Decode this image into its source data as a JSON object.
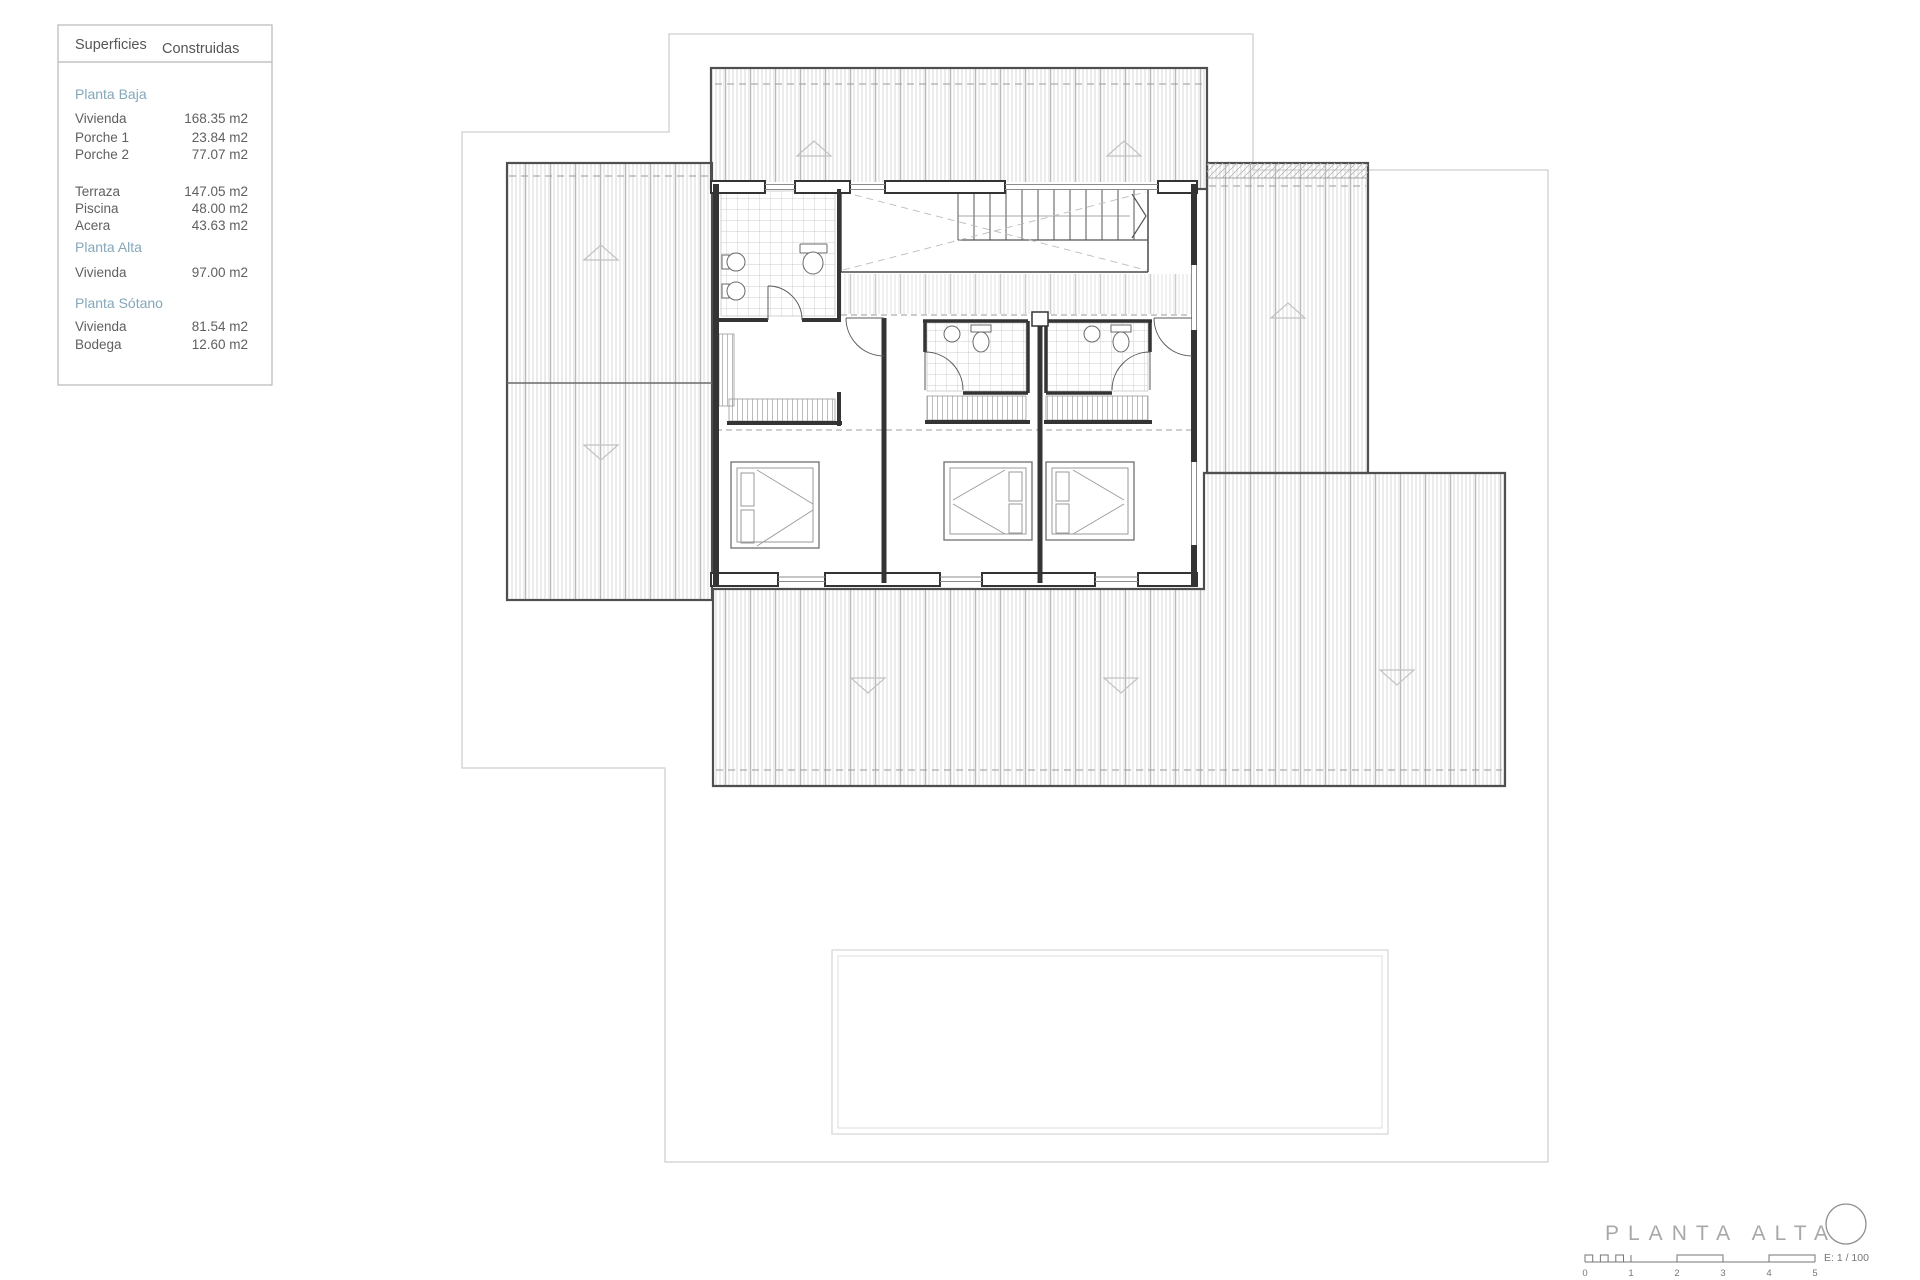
{
  "legend": {
    "header": {
      "col1": "Superficies",
      "col2": "Construidas"
    },
    "planta_baja": {
      "title": "Planta Baja",
      "rows": [
        {
          "label": "Vivienda",
          "value": "168.35 m2"
        },
        {
          "label": "Porche 1",
          "value": "23.84 m2"
        },
        {
          "label": "Porche 2",
          "value": "77.07 m2"
        },
        {
          "label": "Terraza",
          "value": "147.05 m2"
        },
        {
          "label": "Piscina",
          "value": "48.00 m2"
        },
        {
          "label": "Acera",
          "value": "43.63 m2"
        }
      ]
    },
    "planta_alta": {
      "title": "Planta Alta",
      "rows": [
        {
          "label": "Vivienda",
          "value": "97.00 m2"
        }
      ]
    },
    "planta_sotano": {
      "title": "Planta Sótano",
      "rows": [
        {
          "label": "Vivienda",
          "value": "81.54 m2"
        },
        {
          "label": "Bodega",
          "value": "12.60 m2"
        }
      ]
    }
  },
  "title_block": {
    "title": "PLANTA ALTA",
    "scale_label": "E: 1 / 100",
    "scale_ticks": [
      "0",
      "1",
      "2",
      "3",
      "4",
      "5"
    ]
  },
  "colors": {
    "wall_dark": "#343434",
    "roof_outline": "#4f4f4f",
    "hatch_line": "#cccccc",
    "boundary_line": "#cfcfcf",
    "accent_blue": "#84a7ba",
    "text_gray": "#5f5f5f",
    "title_gray": "#a8a8a8"
  }
}
